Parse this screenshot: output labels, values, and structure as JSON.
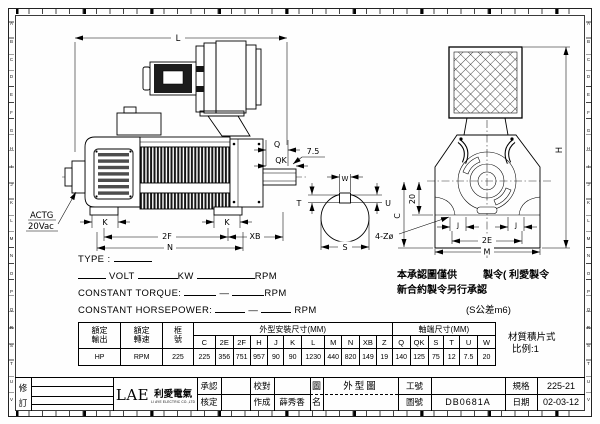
{
  "sheet": {
    "ruler_letters": [
      "A",
      "B",
      "C",
      "D",
      "E",
      "F",
      "G",
      "H",
      "I",
      "J",
      "K",
      "L",
      "M",
      "N",
      "O",
      "P",
      "Q",
      "R",
      "S",
      "T",
      "U",
      "V"
    ]
  },
  "drawing": {
    "labels": {
      "L": "L",
      "Q": "Q",
      "QK": "QK",
      "dim75": "7.5",
      "W": "W",
      "T": "T",
      "U": "U",
      "S": "S",
      "K": "K",
      "F2": "2F",
      "XB": "XB",
      "N": "N",
      "C": "C",
      "d20": "20",
      "holes": "4-Zø",
      "J": "J",
      "E2": "2E",
      "M": "M",
      "H": "H"
    },
    "tacho_label1": "ACTG",
    "tacho_label2": "20Vac"
  },
  "spec_block": {
    "type_label": "TYPE :",
    "volt_label": "VOLT",
    "kw_label": "KW",
    "rpm_label": "RPM",
    "torque_label": "CONSTANT TORQUE:",
    "horsepower_label": "CONSTANT HORSEPOWER:",
    "dash": "—"
  },
  "notes": {
    "approval_line1_left": "本承認圖僅供",
    "approval_line1_right": "製令( 利愛製令",
    "approval_line2": "新合約製令另行承認",
    "shaft_tolerance": "(S公差m6)",
    "material": "材質積片式",
    "scale": "比例:1"
  },
  "dim_table": {
    "rated_output_label": [
      "額定",
      "輸出"
    ],
    "rated_speed_label": [
      "額定",
      "轉速"
    ],
    "frame_label": [
      "框",
      "號"
    ],
    "group_outline": "外型安裝尺寸(MM)",
    "group_shaft": "軸端尺寸(MM)",
    "columns": [
      "C",
      "2E",
      "2F",
      "H",
      "J",
      "K",
      "L",
      "M",
      "N",
      "XB",
      "Z",
      "Q",
      "QK",
      "S",
      "T",
      "U",
      "W"
    ],
    "rated_output_value": "HP",
    "rated_speed_value": "RPM",
    "frame_value": "225",
    "values": [
      "225",
      "356",
      "751",
      "957",
      "90",
      "90",
      "1230",
      "440",
      "820",
      "149",
      "19",
      "140",
      "125",
      "75",
      "12",
      "7.5",
      "20"
    ]
  },
  "title_block": {
    "rev_top": "修",
    "rev_bottom": "訂",
    "logo_text": "LAE",
    "logo_cn": "利愛電氣",
    "logo_sub": "LI AYE ELECTRIC CO.,LTD",
    "approved_label": "承認",
    "checked_label": "核定",
    "proofread_label": "校對",
    "made_label": "作成",
    "made_value": "薛秀香",
    "dwg_name_label_top": "圖",
    "dwg_name_label_bottom": "名",
    "dwg_title": "外型圖",
    "job_no_label": "工號",
    "job_no_value": "",
    "dwg_no_label": "圖號",
    "dwg_no_value": "DB0681A",
    "spec_label": "規格",
    "spec_value": "225-21",
    "date_label": "日期",
    "date_value": "02-03-12"
  }
}
